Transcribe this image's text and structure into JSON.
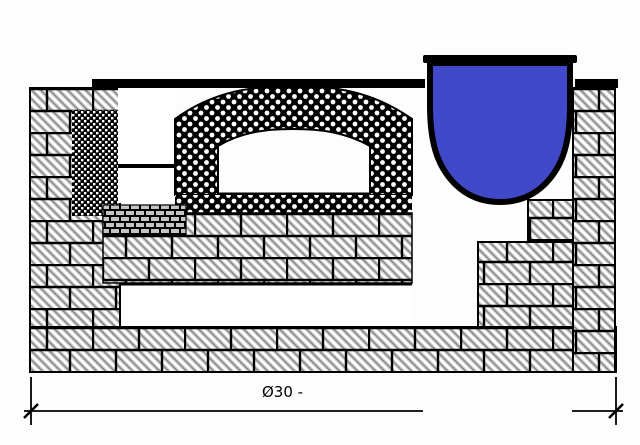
{
  "figure": {
    "kind": "furnace-cross-section-technical-drawing",
    "dimension": {
      "label": "Ø30 -"
    },
    "colors": {
      "melt_blue": "#4149cb",
      "line_black": "#000000",
      "brick_gray": "#cbcbcb",
      "background": "#ffffff"
    }
  }
}
